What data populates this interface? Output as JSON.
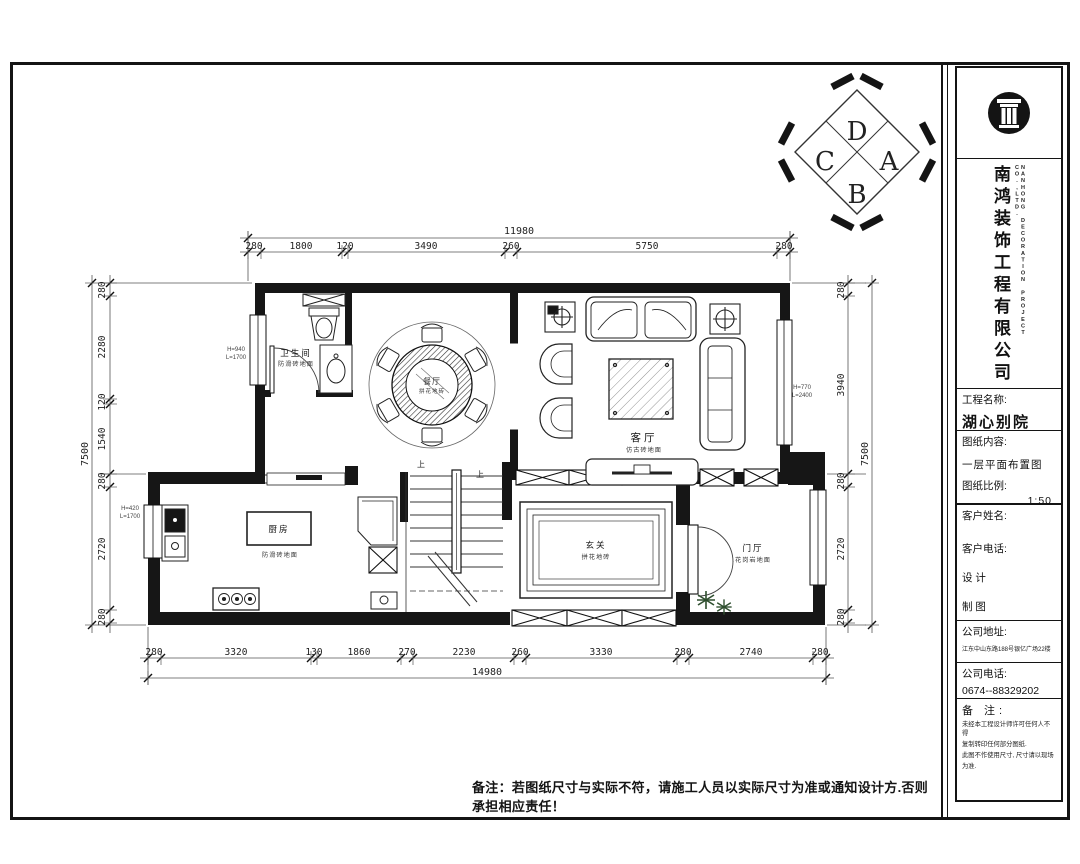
{
  "sheet": {
    "footer_note": "备注：若图纸尺寸与实际不符，请施工人员以实际尺寸为准或通知设计方.否则承担相应责任！"
  },
  "title_block": {
    "company_cn": "南鸿装饰工程有限公司",
    "company_en": "NANHONG DECORATION PROJECT CO.,LTD.",
    "project_label": "工程名称:",
    "project_value": "湖心别院",
    "content_label": "图纸内容:",
    "content_value": "一层平面布置图",
    "scale_label": "图纸比例:",
    "scale_value": "1:50",
    "client_name_label": "客户姓名:",
    "client_phone_label": "客户电话:",
    "designer_label": "设  计",
    "drafter_label": "制  图",
    "address_label": "公司地址:",
    "address_value": "江东中山东路188号银亿广场22楼",
    "phone_label": "公司电话:",
    "phone_value": "0674--88329202",
    "remark_label": "备  注:",
    "remark_lines": [
      "未经本工程设计师许可任何人不得",
      "复制转印任何部分图纸.",
      "此图不作使用尺寸, 尺寸请以现场",
      "为准."
    ]
  },
  "compass": {
    "top": "D",
    "right": "A",
    "bottom": "B",
    "left": "C"
  },
  "rooms": {
    "bathroom": {
      "name": "卫生间",
      "sub": "防滑砖地面"
    },
    "dining": {
      "name": "餐厅",
      "sub": "拼花地砖"
    },
    "living": {
      "name": "客厅",
      "sub": "仿古砖地面"
    },
    "kitchen": {
      "name": "厨房",
      "sub": "防滑砖地面"
    },
    "foyer": {
      "name": "玄关",
      "sub": "拼花地砖"
    },
    "entry": {
      "name": "门厅",
      "sub": "花岗岩地面"
    }
  },
  "stairs": {
    "up": "上"
  },
  "window_notes": {
    "n1": {
      "l1": "H=940",
      "l2": "L=1700"
    },
    "n2": {
      "l1": "H=420",
      "l2": "L=1700"
    },
    "n3": {
      "l1": "H=770",
      "l2": "L=2400"
    }
  },
  "dims": {
    "top": {
      "total": "11980",
      "segs": [
        "280",
        "1800",
        "120",
        "3490",
        "260",
        "5750",
        "280"
      ]
    },
    "bottom": {
      "total": "14980",
      "segs": [
        "280",
        "3320",
        "130",
        "1860",
        "270",
        "2230",
        "260",
        "3330",
        "280",
        "2740",
        "280"
      ]
    },
    "left": {
      "total": "7500",
      "segs": [
        "280",
        "2280",
        "120",
        "1540",
        "280",
        "2720",
        "280"
      ]
    },
    "right": {
      "total": "7500",
      "segs": [
        "280",
        "3940",
        "280",
        "2720",
        "280"
      ]
    }
  }
}
